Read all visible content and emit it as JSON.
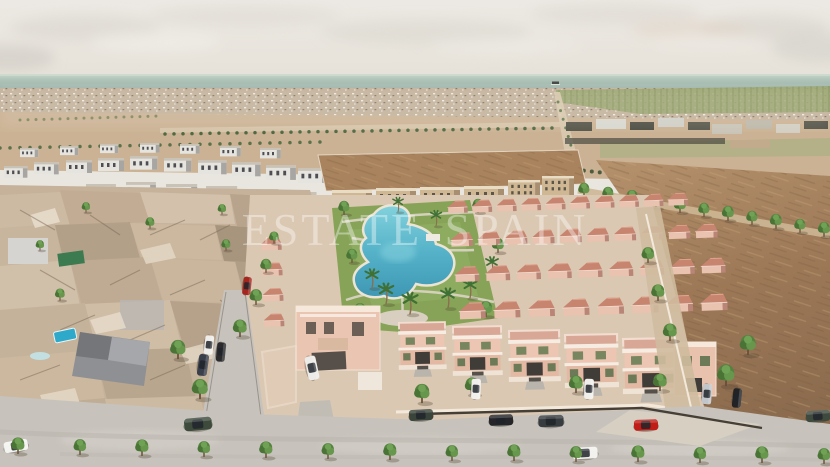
{
  "watermark": {
    "text": "ESTATE SPAIN"
  },
  "scene": {
    "colors": {
      "sky": "#eae7e1",
      "sea": "#a8bdb2",
      "distant_town": "#c3b29c",
      "farmland": "#98a46f",
      "field": "#cbb294",
      "bare_lot": "#a8835d",
      "dirt_field": "#a07c5b",
      "old_town": "#c6b29b",
      "development_ground": "#dbc8b2",
      "villa_wall": "#e8c0ae",
      "villa_roof": "#c68874",
      "lawn": "#86a357",
      "pool": "#4faec6",
      "road": "#c7c3bc",
      "tree": "#5a8a43"
    }
  }
}
